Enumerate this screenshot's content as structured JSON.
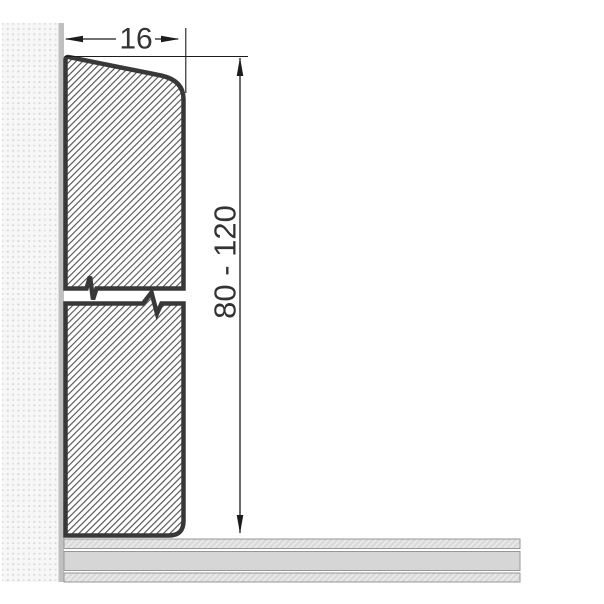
{
  "diagram": {
    "type": "technical-cross-section",
    "subject": "skirting-board-profile-on-wall-above-floor",
    "width_dimension": {
      "label": "16"
    },
    "height_dimension": {
      "label": "80 - 120"
    },
    "icons": {
      "arrowhead_left": "filled-triangle-left",
      "arrowhead_right": "filled-triangle-right",
      "arrowhead_up": "filled-triangle-up",
      "arrowhead_down": "filled-triangle-down"
    },
    "colors": {
      "outline": "#383838",
      "hatch_line": "#444444",
      "dimension_line": "#1c1c1c",
      "label_text": "#333333",
      "wall_background": "#f7f7f7",
      "wall_dots": "#d9d9d9",
      "wall_edge_strip": "#c0c0c0",
      "floor_core": "#d6d6d6",
      "floor_hatch_background": "#dadada",
      "floor_border": "#979797",
      "page_background": "#ffffff"
    }
  }
}
